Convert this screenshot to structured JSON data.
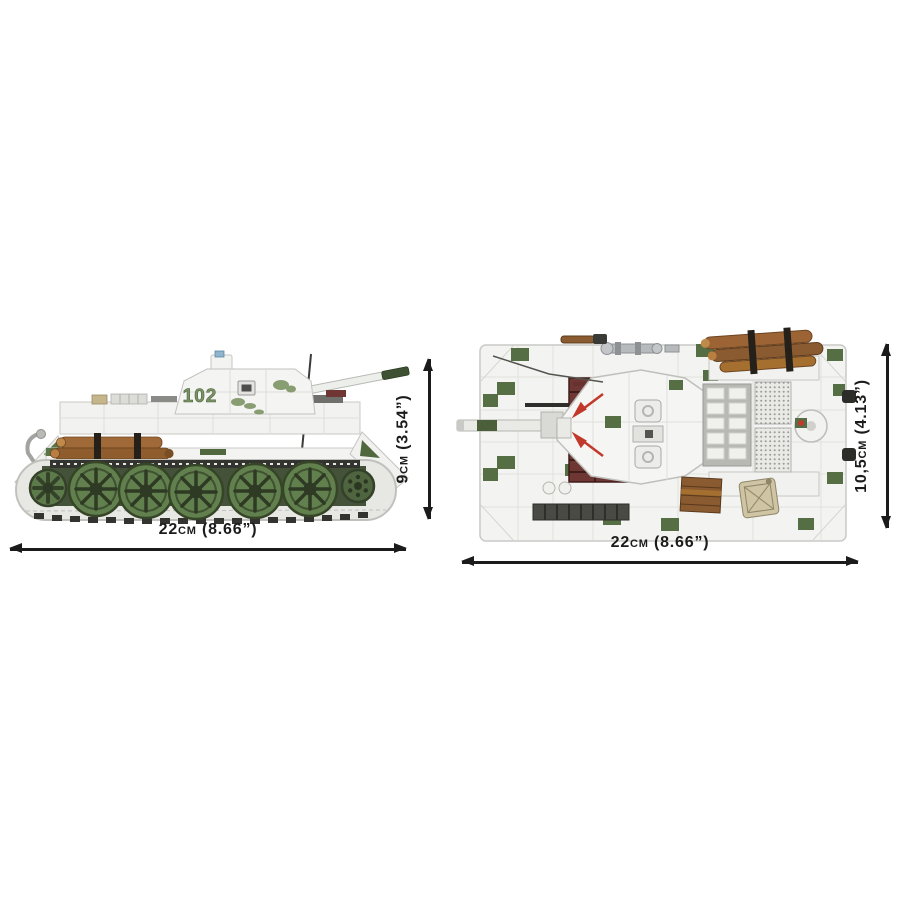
{
  "page": {
    "background_color": "#ffffff"
  },
  "side_view": {
    "width_label": "22cm (8.66”)",
    "height_label": "9cm (3.54”)",
    "turret_marking": "102"
  },
  "top_view": {
    "width_label": "22cm (8.66”)",
    "height_label": "10,5cm (4.13”)"
  },
  "colors": {
    "dimension_lines": "#1b1b1b",
    "brick_white": "#f3f3f1",
    "seam_gray": "#c9c9c5",
    "camo_green": "#5a7447",
    "wheel_green": "#61804e",
    "log_brown": "#9c6434",
    "track_link_maroon": "#6e3733",
    "jerry_can_tan": "#cfc5a4",
    "metal_silver": "#b7babc",
    "marking_green": "#7b9363",
    "arrow_red": "#c0392b"
  }
}
